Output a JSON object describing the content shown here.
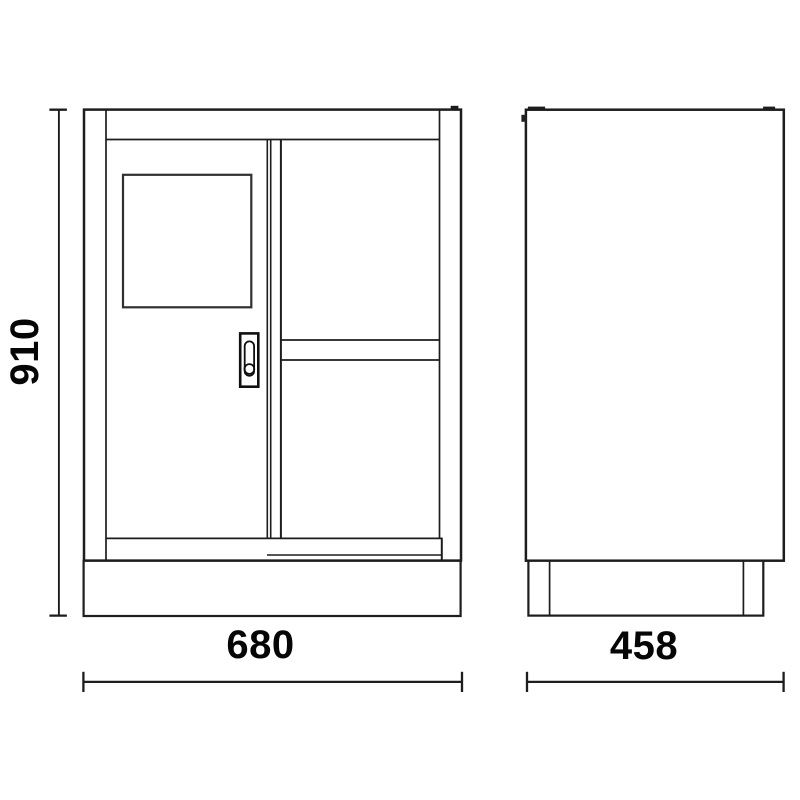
{
  "drawing": {
    "type": "technical-drawing",
    "subject": "cabinet two-view dimensioned drawing",
    "background_color": "#ffffff",
    "line_color": "#1d1d1d",
    "text_color": "#060606",
    "dimensions": {
      "height": "910",
      "width": "680",
      "depth": "458"
    },
    "views": {
      "front": {
        "name": "front view",
        "width_label": "680",
        "height_label": "910",
        "features": [
          "door with window panel",
          "flush handle",
          "center stile",
          "open compartment with shelf",
          "plinth base"
        ]
      },
      "side": {
        "name": "side view",
        "depth_label": "458",
        "features": [
          "hinge bump on front edge",
          "top tabs",
          "plinth base with feet lines"
        ]
      }
    }
  }
}
